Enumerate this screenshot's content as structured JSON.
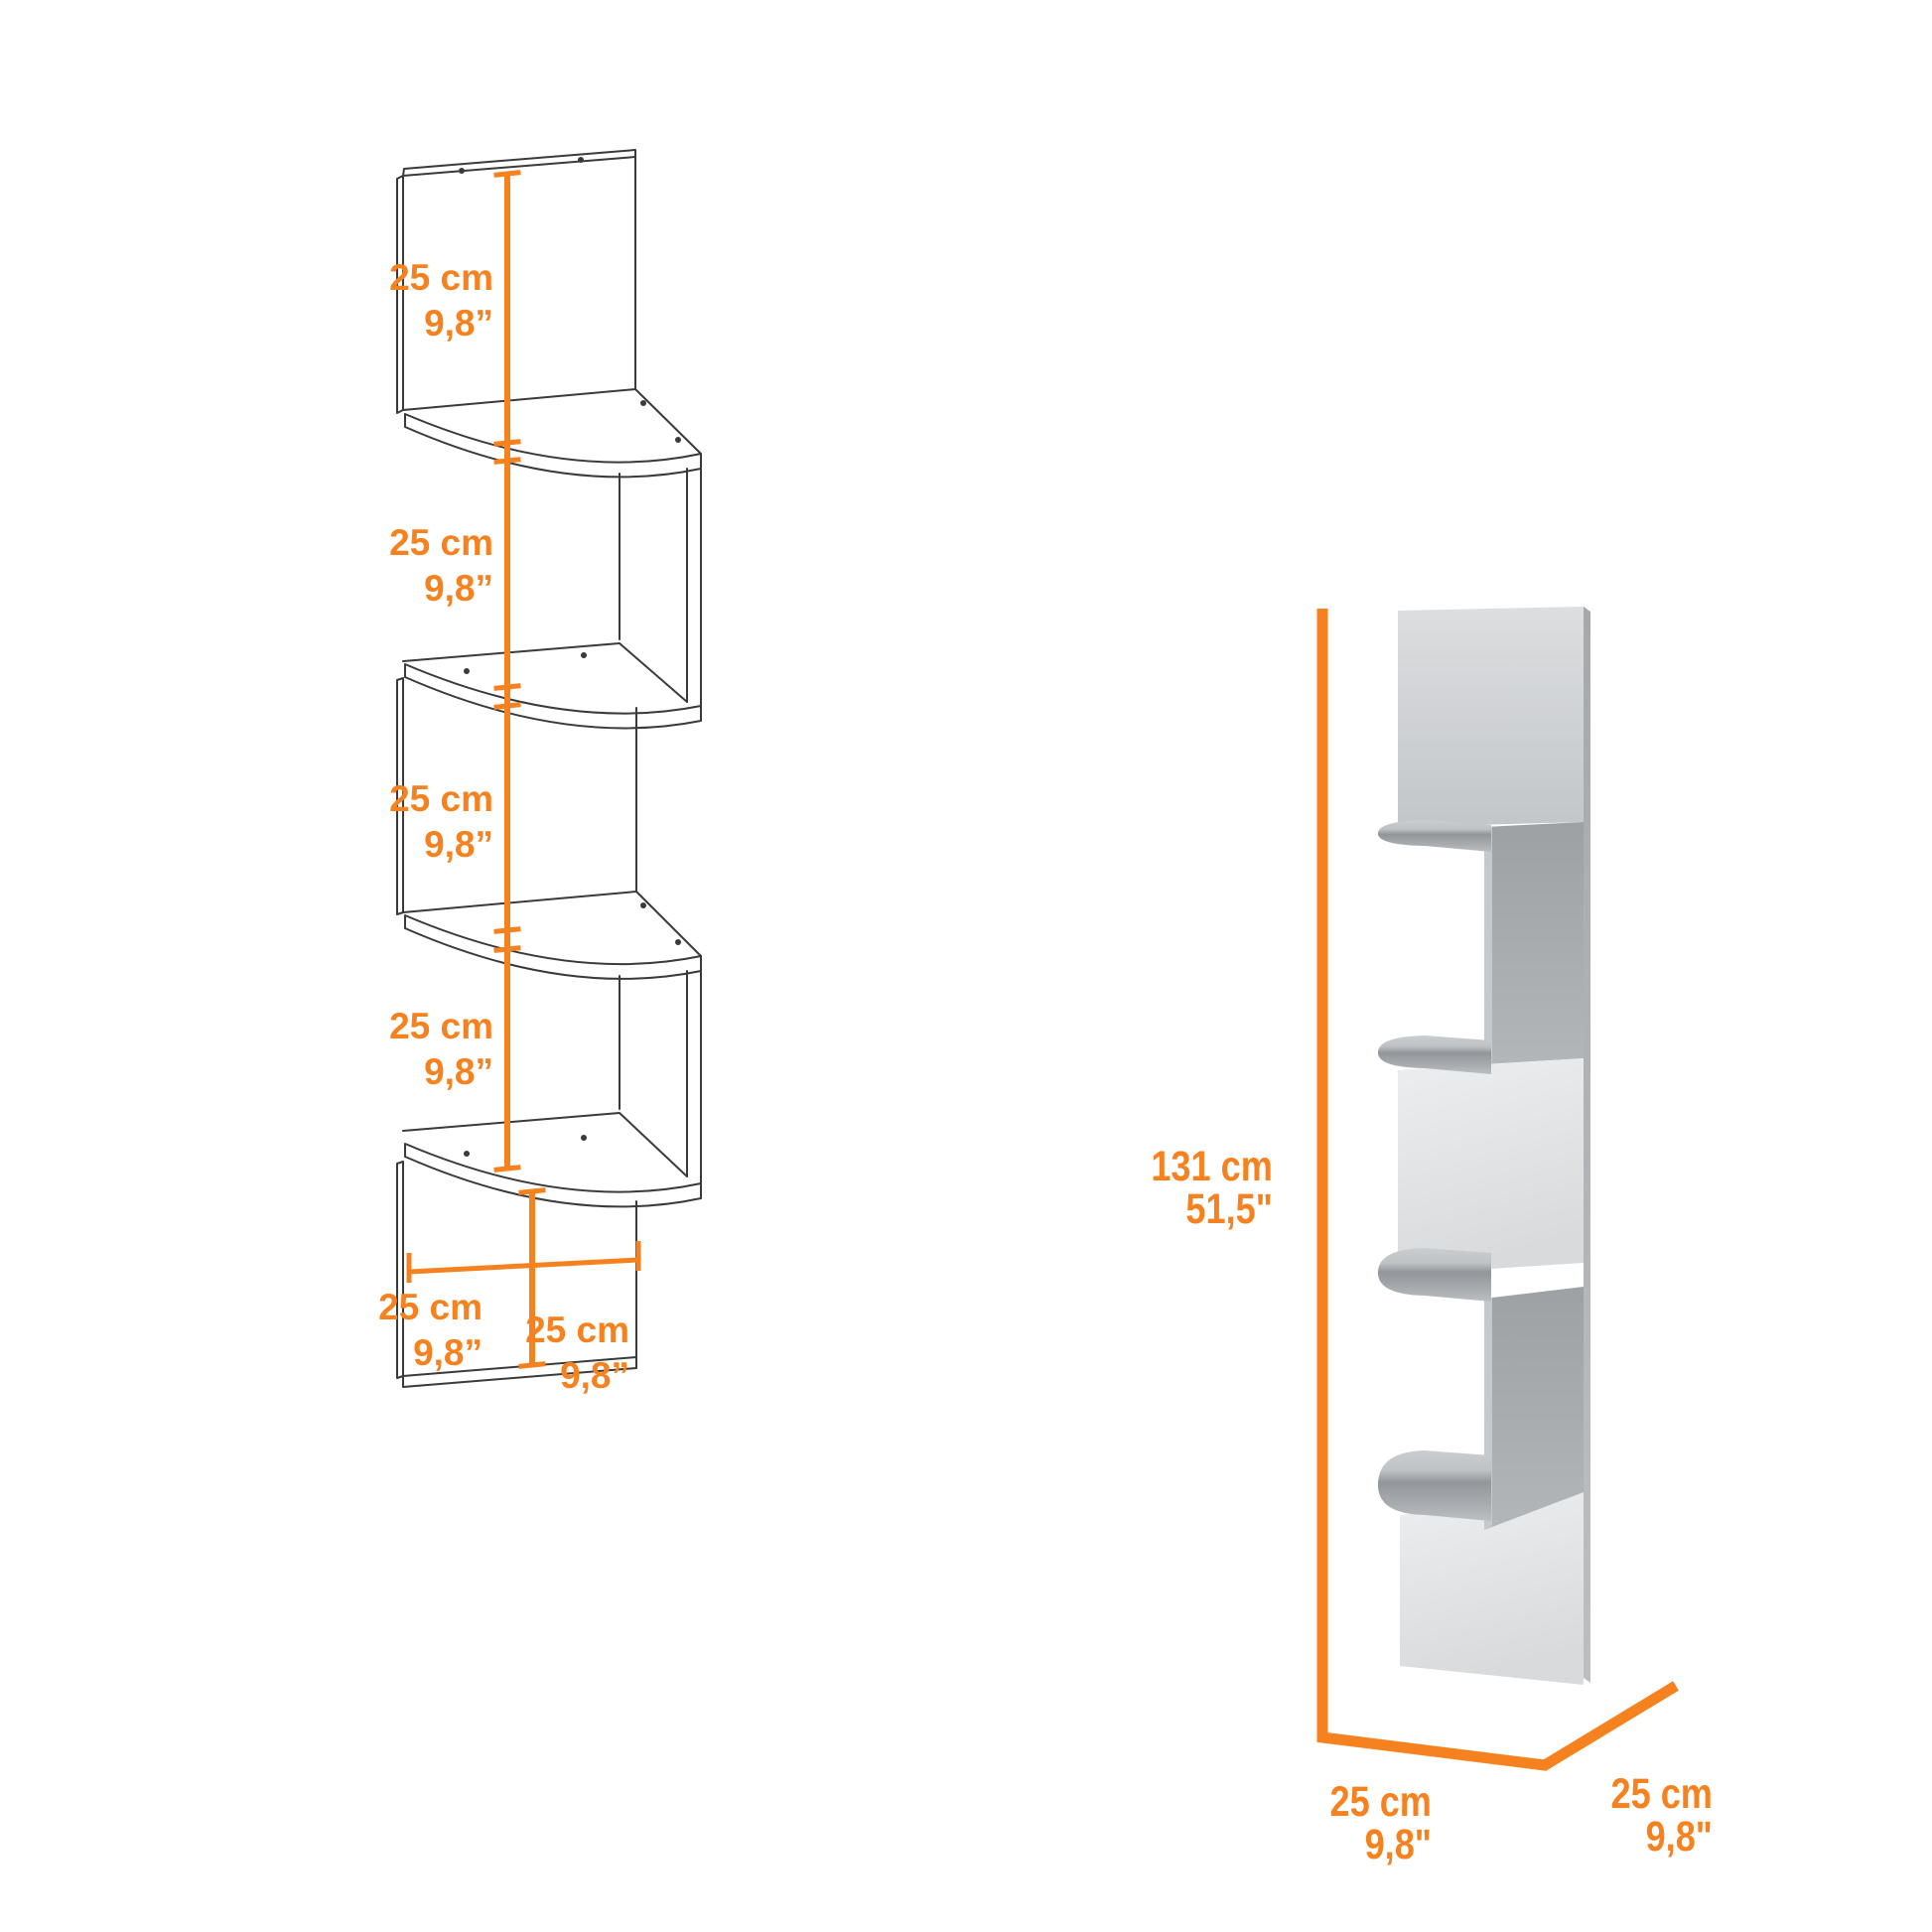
{
  "colors": {
    "accent": "#f5821f",
    "line_art": "#3a3a3a"
  },
  "left_diagram": {
    "type": "technical line drawing of 4-tier zigzag corner wall shelf",
    "section_labels": [
      {
        "metric": "25 cm",
        "imperial": "9,8”"
      },
      {
        "metric": "25 cm",
        "imperial": "9,8”"
      },
      {
        "metric": "25 cm",
        "imperial": "9,8”"
      },
      {
        "metric": "25 cm",
        "imperial": "9,8”"
      }
    ],
    "width_label": {
      "metric": "25 cm",
      "imperial": "9,8”"
    },
    "bottom_section_label": {
      "metric": "25 cm",
      "imperial": "9,8”"
    }
  },
  "right_diagram": {
    "type": "3D render of corner wall shelf",
    "height_label": {
      "metric": "131 cm",
      "imperial": "51,5\""
    },
    "depth_label": {
      "metric": "25 cm",
      "imperial": "9,8\""
    },
    "width_label": {
      "metric": "25 cm",
      "imperial": "9,8\""
    }
  }
}
